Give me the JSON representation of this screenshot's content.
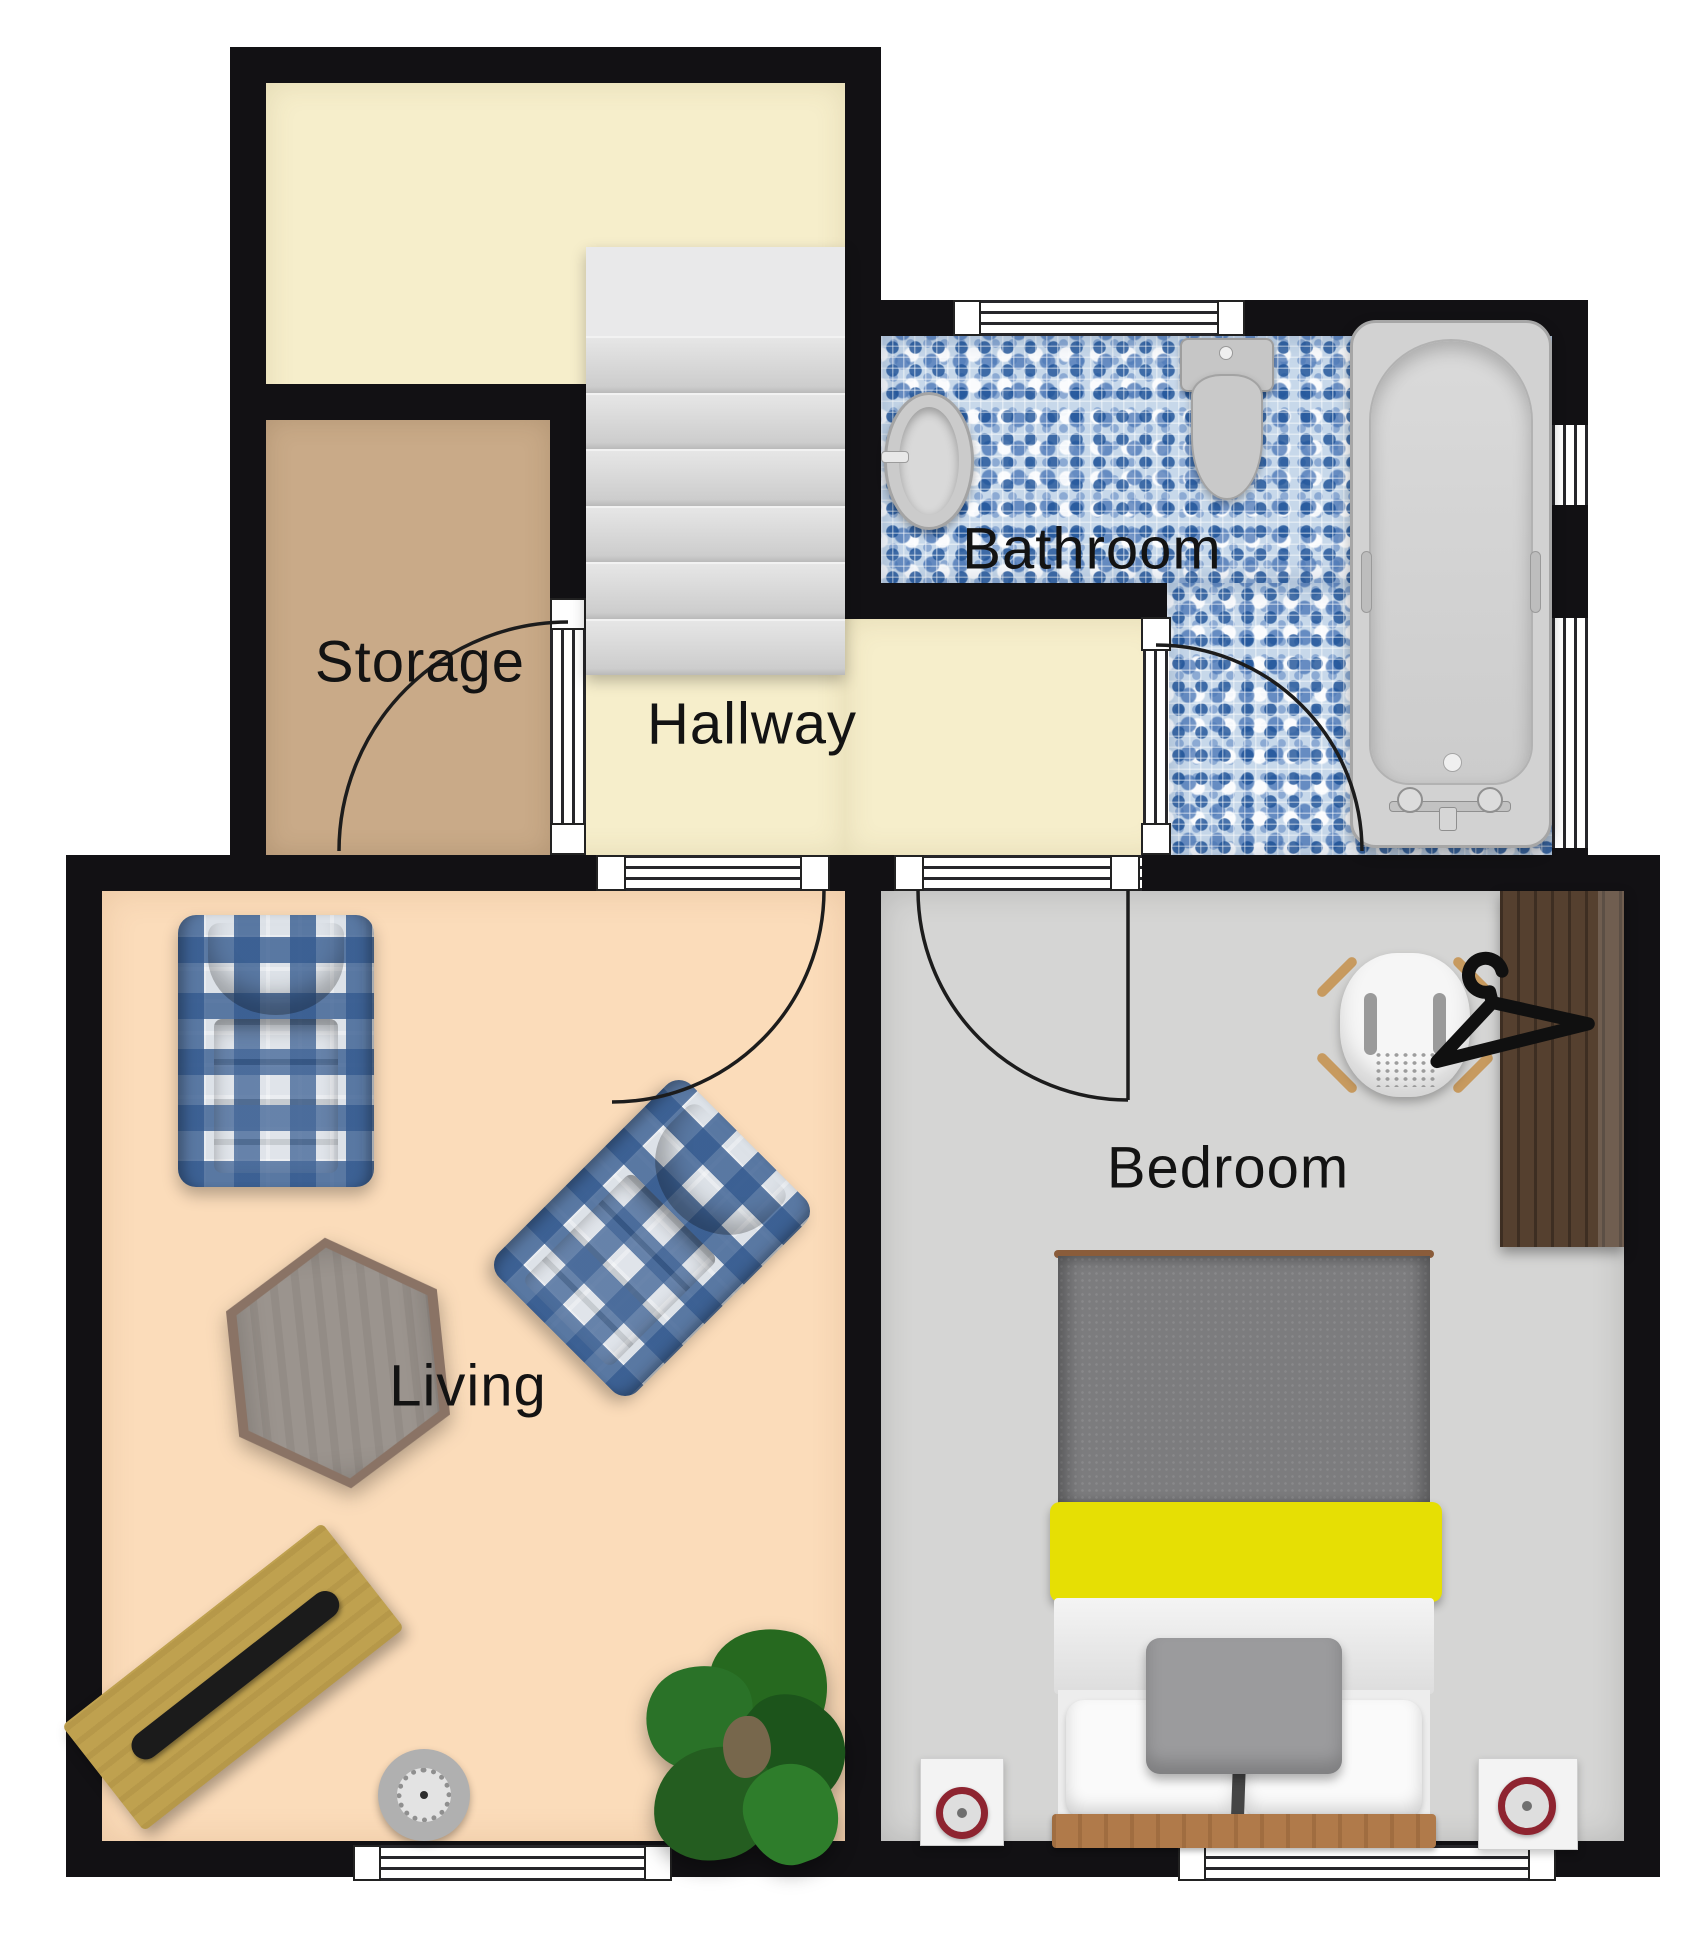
{
  "title": "apartment-floor-plan",
  "rooms": {
    "storage": {
      "label": "Storage",
      "floor_color": "#c9aa88"
    },
    "hallway": {
      "label": "Hallway",
      "floor_color": "#f6eecb"
    },
    "bathroom": {
      "label": "Bathroom",
      "floor_color": "#c7d8ea"
    },
    "living": {
      "label": "Living",
      "floor_color": "#fbdcba"
    },
    "bedroom": {
      "label": "Bedroom",
      "floor_color": "#d5d5d4"
    },
    "landing": {
      "label": "",
      "floor_color": "#f6eecb"
    }
  },
  "colors": {
    "walls": "#121114",
    "bed_accent_stripe": "#e6df04",
    "bed_duvet": "#7c7c7e",
    "wardrobe_wood": "#55402f",
    "bench_wood": "#bfa14f",
    "plant_green": "#2a7228",
    "clock_ring": "#8e2430"
  },
  "furniture": [
    "stairs",
    "storage-door",
    "living-door",
    "bedroom-door",
    "bathroom-door",
    "bathroom-sink",
    "toilet",
    "bathtub",
    "armchair",
    "armchair-rotated",
    "hexagon-side-table",
    "wood-bench",
    "soundbar",
    "round-speaker",
    "potted-plant",
    "double-bed",
    "pillows",
    "nightstand-left",
    "nightstand-right",
    "alarm-clock",
    "desk-chair",
    "wardrobe",
    "clothes-hanger-icon",
    "window-bathroom-top",
    "window-bathroom-right-upper",
    "window-bathroom-right-lower",
    "window-living-bottom",
    "window-bedroom-bottom"
  ]
}
